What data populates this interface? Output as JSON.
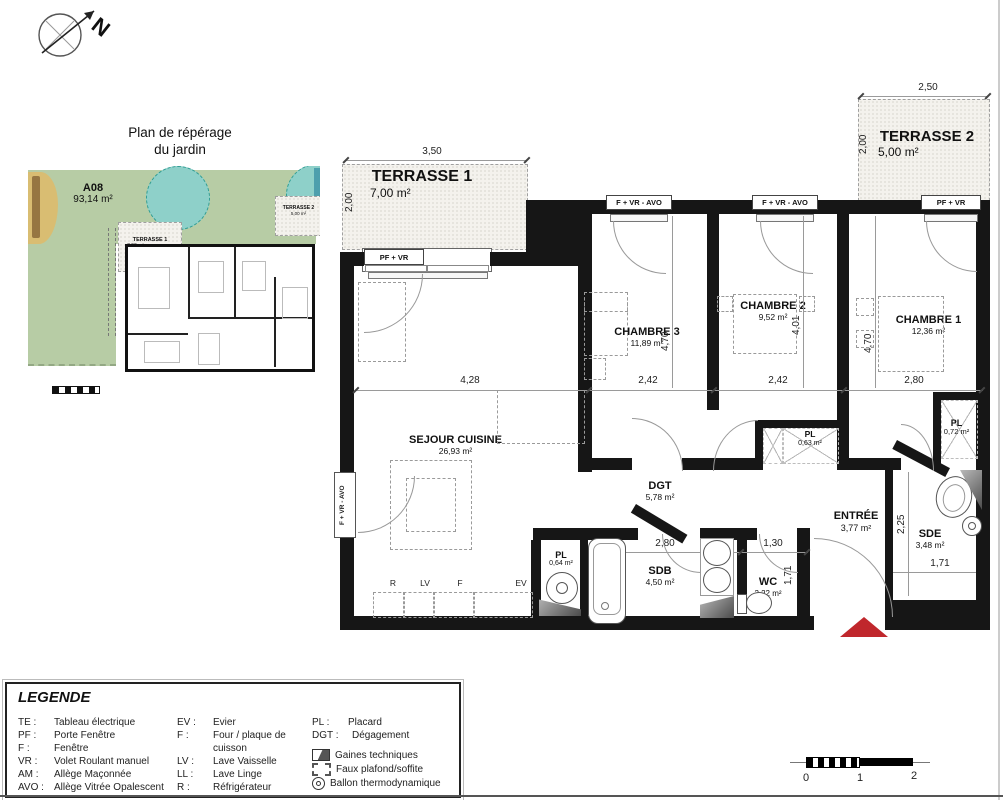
{
  "compass": {
    "north_label": "N"
  },
  "garden": {
    "title_line1": "Plan de répérage",
    "title_line2": "du jardin",
    "unit_code": "A08",
    "unit_area": "93,14 m²",
    "terrasse1_label": "TERRASSE 1",
    "terrasse1_area": "7,00 m²",
    "terrasse2_label": "TERRASSE 2",
    "terrasse2_area": "5,00 m²"
  },
  "plan": {
    "terrasse1": {
      "name": "TERRASSE 1",
      "area": "7,00 m²",
      "dim_w": "3,50",
      "dim_h": "2,00",
      "door": "PF + VR"
    },
    "terrasse2": {
      "name": "TERRASSE 2",
      "area": "5,00 m²",
      "dim_w": "2,50",
      "dim_h": "2,00",
      "door": "PF + VR"
    },
    "windows": {
      "chambre3": "F + VR - AVO",
      "chambre2": "F + VR - AVO",
      "sejour_side": "F + VR - AVO"
    },
    "chambre3": {
      "name": "CHAMBRE 3",
      "area": "11,89 m²",
      "dim_w": "2,42",
      "dim_h": "4,70"
    },
    "chambre2": {
      "name": "CHAMBRE 2",
      "area": "9,52 m²",
      "dim_w": "2,42",
      "dim_h": "4,01"
    },
    "chambre1": {
      "name": "CHAMBRE 1",
      "area": "12,36 m²",
      "dim_w": "2,80",
      "dim_h": "4,70"
    },
    "sejour": {
      "name": "SEJOUR CUISINE",
      "area": "26,93 m²",
      "dim_w": "4,28"
    },
    "dgt": {
      "name": "DGT",
      "area": "5,78 m²"
    },
    "sdb": {
      "name": "SDB",
      "area": "4,50 m²",
      "dim_w": "2,80"
    },
    "wc": {
      "name": "WC",
      "area": "2,22 m²",
      "dim_w": "1,30",
      "dim_h": "1,71"
    },
    "sde": {
      "name": "SDE",
      "area": "3,48 m²",
      "dim_w": "1,71",
      "dim_h": "2,25"
    },
    "entree": {
      "name": "ENTRÉE",
      "area": "3,77 m²"
    },
    "pl_kitchen": {
      "name": "PL",
      "area": "0,64 m²"
    },
    "pl_couloir": {
      "name": "PL",
      "area": "0,63 m²"
    },
    "pl_entree": {
      "name": "PL",
      "area": "0,72 m²"
    },
    "appliances": {
      "r": "R",
      "lv": "LV",
      "f": "F",
      "ev": "EV"
    }
  },
  "legend": {
    "title": "LEGENDE",
    "col1": [
      {
        "abbr": "TE :",
        "label": "Tableau électrique"
      },
      {
        "abbr": "PF :",
        "label": "Porte Fenêtre"
      },
      {
        "abbr": "F :",
        "label": "Fenêtre"
      },
      {
        "abbr": "VR :",
        "label": "Volet Roulant manuel"
      },
      {
        "abbr": "AM :",
        "label": "Allège Maçonnée"
      },
      {
        "abbr": "AVO :",
        "label": "Allège Vitrée Opalescent"
      }
    ],
    "col2": [
      {
        "abbr": "EV :",
        "label": "Evier"
      },
      {
        "abbr": "F :",
        "label": "Four / plaque de cuisson"
      },
      {
        "abbr": "LV :",
        "label": "Lave Vaisselle"
      },
      {
        "abbr": "LL :",
        "label": "Lave Linge"
      },
      {
        "abbr": "R :",
        "label": "Réfrigérateur"
      }
    ],
    "col3": [
      {
        "abbr": "PL :",
        "label": "Placard"
      },
      {
        "abbr": "DGT :",
        "label": "Dégagement"
      }
    ],
    "symbols": [
      {
        "label": "Gaines techniques"
      },
      {
        "label": "Faux plafond/soffite"
      },
      {
        "label": "Ballon thermodynamique"
      }
    ]
  },
  "scalebar": {
    "t0": "0",
    "t1": "1",
    "t2": "2"
  }
}
